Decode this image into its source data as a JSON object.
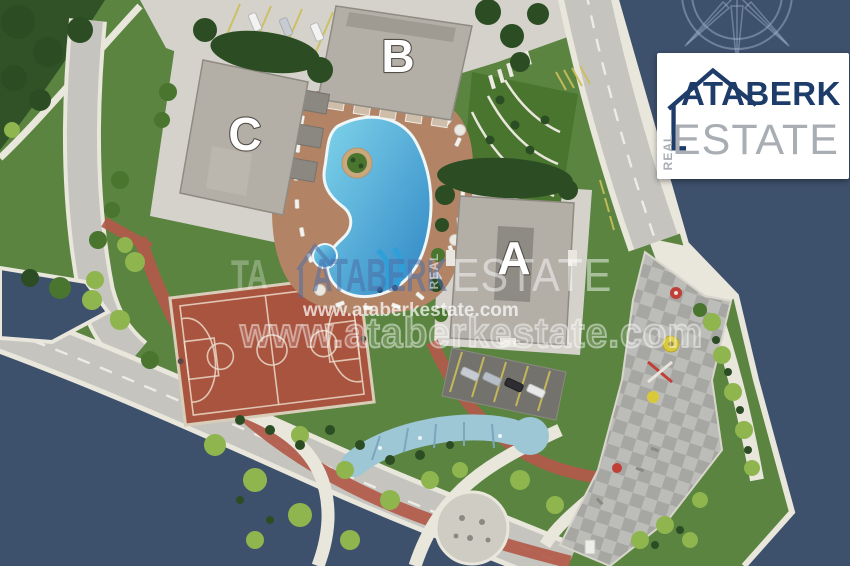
{
  "buildings": {
    "a": "A",
    "b": "B",
    "c": "C"
  },
  "logo": {
    "brand": "ATABERK",
    "estate": "ESTATE",
    "real": "REAL"
  },
  "watermark": {
    "brand": "ATABERK",
    "estate": "ESTATE",
    "real": "REAL",
    "fragment": "TA",
    "url_small": "www.ataberkestate.com",
    "url_large": "www.ataberkestate.com"
  },
  "icons": {
    "compass": "compass-rose-icon",
    "logo_house": "house-outline-icon",
    "watermark_house": "house-outline-icon"
  },
  "colors": {
    "sea": "#3d506c",
    "land": "#5a8440",
    "grass_dark": "#2c4d24",
    "grass_mid": "#49752f",
    "grass_light": "#8fb54e",
    "paving": "#d4d2ca",
    "road": "#c5c4be",
    "stone": "#e9e6dc",
    "asphalt": "#73726c",
    "roof": "#b3afa7",
    "roof_inner": "#8e8a84",
    "deck": "#b28465",
    "pool_light": "#7ed3ea",
    "pool_deep": "#2f86c4",
    "court": "#a9543f",
    "brick": "#b25a4a",
    "canal": "#9ec7d6",
    "checker_a": "#bcbcb8",
    "checker_b": "#a6a6a2",
    "line_yellow": "#cdbf5a",
    "logo_navy": "#1d3c69",
    "logo_gray": "#a9aeb4",
    "wm_blue": "#4f6fa8",
    "label": "#ffffff"
  }
}
